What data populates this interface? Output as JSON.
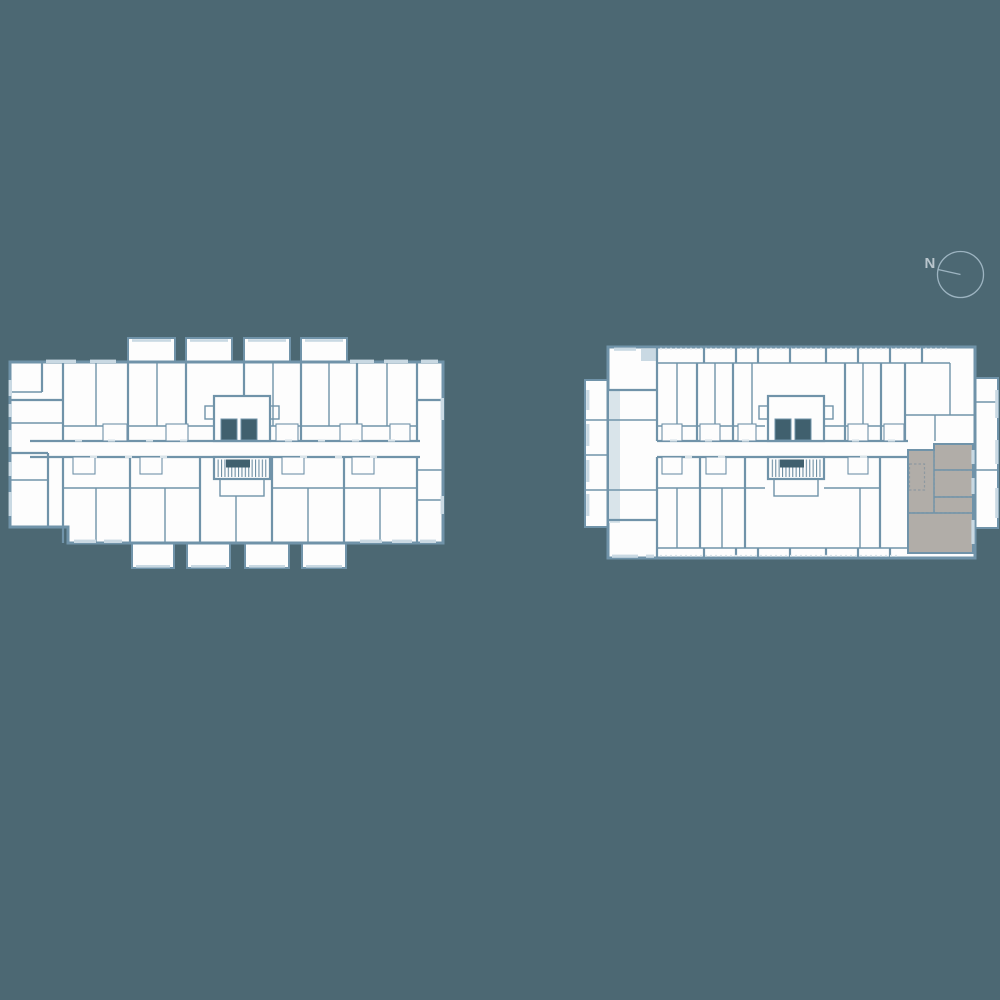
{
  "compass": {
    "label": "N"
  },
  "colors": {
    "bg": "#4c6873",
    "wall": "#7093a9",
    "room": "#fdfdfd",
    "window": "#c9d9e3",
    "window_light": "#d9e4ea",
    "shaft": "#40606e",
    "hatch": "#6d8ea3",
    "unit": "#b1ada8",
    "unit_border": "#8e99a0",
    "compass": "#9db4c1",
    "compass_text": "#b9c5cc"
  }
}
